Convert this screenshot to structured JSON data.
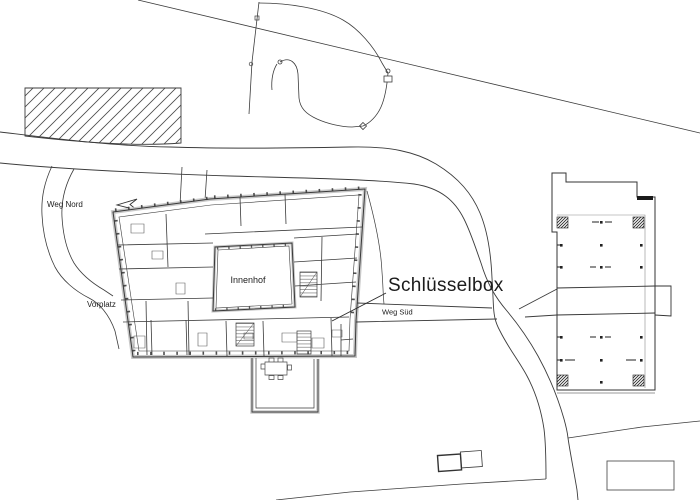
{
  "page": {
    "background": "#ffffff",
    "line_color": "#3c3c3c",
    "wall_fill": "#c8c8c8"
  },
  "plan": {
    "labels": {
      "weg_nord": "Weg Nord",
      "vorplatz": "Vorplatz",
      "innenhof": "Innenhof",
      "schluesselbox": "Schlüsselbox",
      "weg_sued": "Weg Süd"
    }
  }
}
